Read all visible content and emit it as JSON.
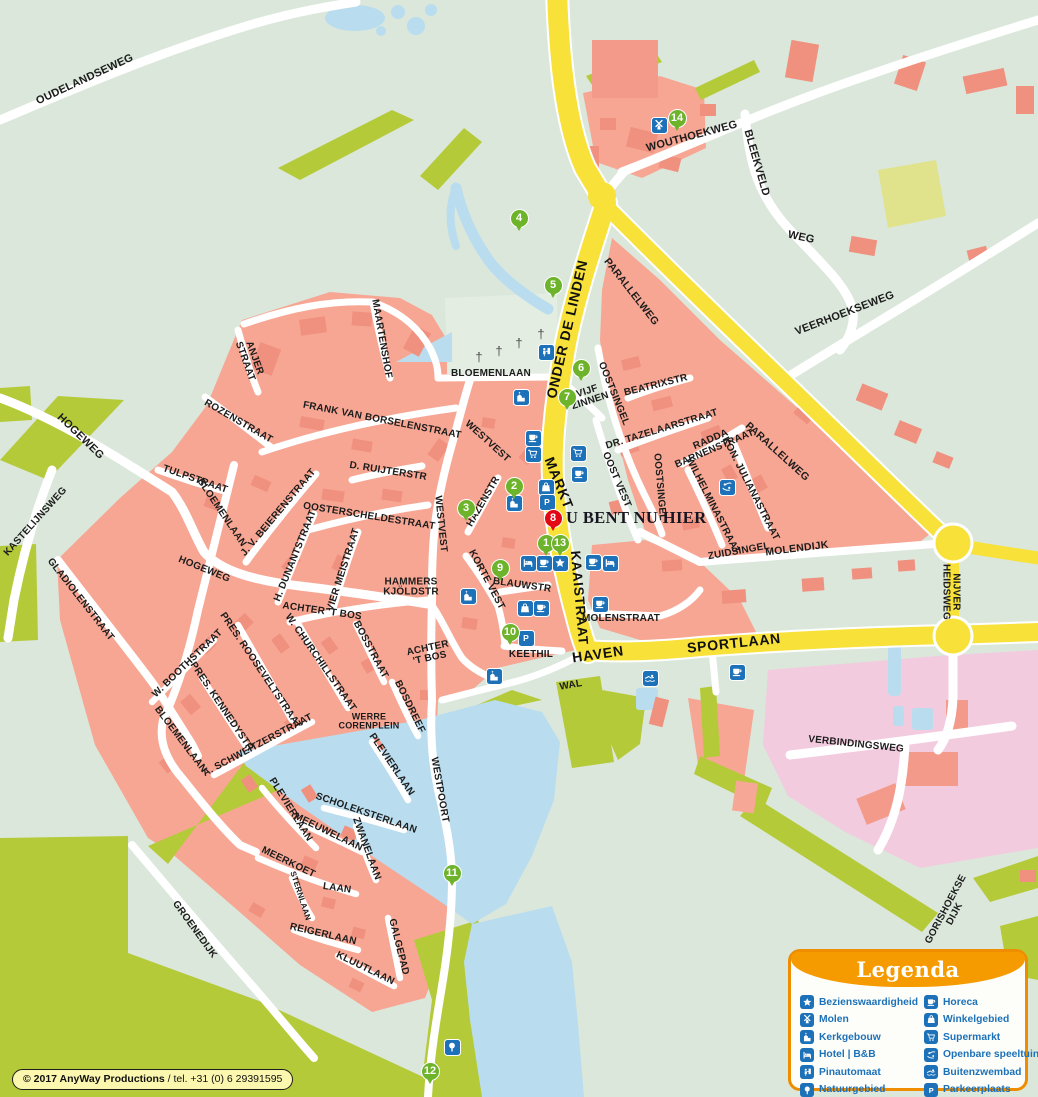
{
  "map": {
    "you_are_here": "U BENT NU HIER",
    "copyright": {
      "owner": "© 2017 AnyWay Productions",
      "phone": " / tel. +31 (0) 6 29391595"
    },
    "colors": {
      "background": "#dbe7db",
      "urban": "#f7a693",
      "buildings": "#f0907f",
      "green_area": "#b5ca38",
      "water": "#b9ddef",
      "industry_pink": "#f3cbdf",
      "main_road_yellow": "#f8e139",
      "icon_blue": "#1d71b8",
      "marker_green": "#6db32b",
      "marker_red": "#e30615",
      "legend_orange": "#f59b00",
      "legend_text_blue": "#1d71b8",
      "copyright_yellow": "#fbf7ae"
    },
    "legend": {
      "title": "Legenda",
      "columns": [
        [
          {
            "icon": "star",
            "label": "Bezienswaardigheid"
          },
          {
            "icon": "windmill",
            "label": "Molen"
          },
          {
            "icon": "church",
            "label": "Kerkgebouw"
          },
          {
            "icon": "bed",
            "label": "Hotel | B&B"
          },
          {
            "icon": "atm",
            "label": "Pinautomaat"
          },
          {
            "icon": "tree",
            "label": "Natuurgebied"
          }
        ],
        [
          {
            "icon": "cup",
            "label": "Horeca"
          },
          {
            "icon": "bag",
            "label": "Winkelgebied"
          },
          {
            "icon": "cart",
            "label": "Supermarkt"
          },
          {
            "icon": "playground",
            "label": "Openbare speeltuin"
          },
          {
            "icon": "swimmer",
            "label": "Buitenzwembad"
          },
          {
            "icon": "parking",
            "label": "Parkeerplaats"
          }
        ]
      ]
    },
    "markers": [
      {
        "n": "1",
        "x": 546,
        "y": 543,
        "color": "green"
      },
      {
        "n": "2",
        "x": 514,
        "y": 486,
        "color": "green"
      },
      {
        "n": "3",
        "x": 466,
        "y": 508,
        "color": "green"
      },
      {
        "n": "4",
        "x": 519,
        "y": 218,
        "color": "green"
      },
      {
        "n": "5",
        "x": 553,
        "y": 285,
        "color": "green"
      },
      {
        "n": "6",
        "x": 581,
        "y": 368,
        "color": "green"
      },
      {
        "n": "7",
        "x": 567,
        "y": 397,
        "color": "green"
      },
      {
        "n": "8",
        "x": 553,
        "y": 518,
        "color": "red"
      },
      {
        "n": "9",
        "x": 500,
        "y": 568,
        "color": "green"
      },
      {
        "n": "10",
        "x": 510,
        "y": 632,
        "color": "green"
      },
      {
        "n": "11",
        "x": 452,
        "y": 873,
        "color": "green"
      },
      {
        "n": "12",
        "x": 430,
        "y": 1071,
        "color": "green"
      },
      {
        "n": "13",
        "x": 560,
        "y": 543,
        "color": "green"
      },
      {
        "n": "14",
        "x": 677,
        "y": 118,
        "color": "green"
      }
    ],
    "pois": [
      {
        "type": "windmill",
        "x": 659,
        "y": 125
      },
      {
        "type": "atm",
        "x": 546,
        "y": 352
      },
      {
        "type": "church",
        "x": 521,
        "y": 397
      },
      {
        "type": "cup",
        "x": 533,
        "y": 438
      },
      {
        "type": "cart",
        "x": 533,
        "y": 454
      },
      {
        "type": "cart",
        "x": 578,
        "y": 453
      },
      {
        "type": "cup",
        "x": 579,
        "y": 474
      },
      {
        "type": "bag",
        "x": 546,
        "y": 487
      },
      {
        "type": "parking",
        "x": 547,
        "y": 502
      },
      {
        "type": "church",
        "x": 514,
        "y": 503
      },
      {
        "type": "bed",
        "x": 528,
        "y": 563
      },
      {
        "type": "cup",
        "x": 544,
        "y": 563
      },
      {
        "type": "star",
        "x": 560,
        "y": 563
      },
      {
        "type": "cup",
        "x": 593,
        "y": 562
      },
      {
        "type": "bed",
        "x": 610,
        "y": 563
      },
      {
        "type": "church",
        "x": 468,
        "y": 596
      },
      {
        "type": "cup",
        "x": 600,
        "y": 604
      },
      {
        "type": "bag",
        "x": 525,
        "y": 608
      },
      {
        "type": "cup",
        "x": 541,
        "y": 608
      },
      {
        "type": "parking",
        "x": 526,
        "y": 638
      },
      {
        "type": "church",
        "x": 494,
        "y": 676
      },
      {
        "type": "swimmer",
        "x": 650,
        "y": 678
      },
      {
        "type": "cup",
        "x": 737,
        "y": 672
      },
      {
        "type": "playground",
        "x": 727,
        "y": 487
      },
      {
        "type": "tree",
        "x": 452,
        "y": 1047
      }
    ],
    "street_labels": [
      {
        "t": "OUDELANDSEWEG",
        "x": 85,
        "y": 80,
        "r": -25,
        "s": 11
      },
      {
        "t": "WOUTHOEKWEG",
        "x": 692,
        "y": 137,
        "r": -15,
        "s": 11
      },
      {
        "t": "BLEEKVELD",
        "x": 756,
        "y": 163,
        "r": 74,
        "s": 11
      },
      {
        "t": "WEG",
        "x": 801,
        "y": 238,
        "r": 12,
        "s": 11
      },
      {
        "t": "VEERHOEKSEWEG",
        "x": 845,
        "y": 314,
        "r": -21,
        "s": 11
      },
      {
        "t": "PARALLELWEG",
        "x": 631,
        "y": 292,
        "r": 52,
        "s": 10.5
      },
      {
        "t": "PARALLELWEG",
        "x": 777,
        "y": 452,
        "r": 42,
        "s": 10.5
      },
      {
        "t": "ONDER DE LINDEN",
        "x": 567,
        "y": 329,
        "r": -77,
        "s": 14,
        "road": true
      },
      {
        "t": "MARKT",
        "x": 559,
        "y": 483,
        "r": 68,
        "s": 14,
        "road": true
      },
      {
        "t": "KAAISTRAAT",
        "x": 579,
        "y": 598,
        "r": 85,
        "s": 13.5,
        "road": true
      },
      {
        "t": "HAVEN",
        "x": 598,
        "y": 654,
        "r": -8,
        "s": 14,
        "road": true
      },
      {
        "t": "SPORTLAAN",
        "x": 734,
        "y": 643,
        "r": -6,
        "s": 14,
        "road": true
      },
      {
        "lines": [
          "NIJVER",
          "HEIDSWEG"
        ],
        "x": 950,
        "y": 592,
        "r": 90,
        "s": 10
      },
      {
        "t": "MOLENDIJK",
        "x": 797,
        "y": 549,
        "r": -7,
        "s": 10.5
      },
      {
        "t": "ZUIDSINGEL",
        "x": 739,
        "y": 552,
        "r": -10,
        "s": 10
      },
      {
        "t": "VERBINDINGSWEG",
        "x": 856,
        "y": 745,
        "r": 6,
        "s": 10
      },
      {
        "t": "GORISHOEKSE DIJK",
        "x": 951,
        "y": 912,
        "r": -62,
        "s": 10
      },
      {
        "t": "BLOEMENLAAN",
        "x": 491,
        "y": 374,
        "r": 0,
        "s": 10
      },
      {
        "t": "MAARTENSHOF",
        "x": 381,
        "y": 339,
        "r": 80,
        "s": 10
      },
      {
        "t": "FRANK VAN BORSELENSTRAAT",
        "x": 382,
        "y": 421,
        "r": 11,
        "s": 10
      },
      {
        "t": "D. RUIJTERSTR",
        "x": 388,
        "y": 472,
        "r": 9,
        "s": 10
      },
      {
        "t": "OOSTERSCHELDESTRAAT",
        "x": 369,
        "y": 517,
        "r": 9,
        "s": 10
      },
      {
        "t": "WESTVEST",
        "x": 487,
        "y": 442,
        "r": 42,
        "s": 10
      },
      {
        "t": "WESTVEST",
        "x": 440,
        "y": 524,
        "r": 84,
        "s": 10
      },
      {
        "t": "HAZENSTR",
        "x": 484,
        "y": 502,
        "r": -60,
        "s": 10
      },
      {
        "t": "KORTE VEST",
        "x": 486,
        "y": 580,
        "r": 62,
        "s": 10
      },
      {
        "t": "BLAUWSTR",
        "x": 522,
        "y": 586,
        "r": 8,
        "s": 10
      },
      {
        "lines": [
          "HAMMERS",
          "KJÖLDSTR"
        ],
        "x": 411,
        "y": 588,
        "r": 0,
        "s": 10
      },
      {
        "t": "ACHTER 'T BOS",
        "x": 322,
        "y": 612,
        "r": 8,
        "s": 10
      },
      {
        "lines": [
          "ACHTER",
          "'T BOS"
        ],
        "x": 429,
        "y": 654,
        "r": -12,
        "s": 10
      },
      {
        "t": "KEETHIL",
        "x": 531,
        "y": 655,
        "r": 0,
        "s": 10
      },
      {
        "t": "WAL",
        "x": 571,
        "y": 686,
        "r": -10,
        "s": 10
      },
      {
        "t": "MOLENSTRAAT",
        "x": 621,
        "y": 619,
        "r": 0,
        "s": 10
      },
      {
        "t": "OOST VEST",
        "x": 616,
        "y": 480,
        "r": 67,
        "s": 10
      },
      {
        "t": "OOSTSINGEL",
        "x": 613,
        "y": 394,
        "r": 68,
        "s": 10
      },
      {
        "t": "OOSTSINGEL",
        "x": 659,
        "y": 487,
        "r": 85,
        "s": 10
      },
      {
        "lines": [
          "VIJF",
          "ZINNEN"
        ],
        "x": 589,
        "y": 397,
        "r": -18,
        "s": 10
      },
      {
        "t": "BEATRIXSTR",
        "x": 656,
        "y": 386,
        "r": -14,
        "s": 10
      },
      {
        "t": "DR. TAZELAARSTRAAT",
        "x": 662,
        "y": 430,
        "r": -17,
        "s": 10
      },
      {
        "lines": [
          "RADDA",
          "BARNENSTRAAT"
        ],
        "x": 713,
        "y": 445,
        "r": -23,
        "s": 10
      },
      {
        "t": "KON. JULIANASTRAAT",
        "x": 750,
        "y": 489,
        "r": 63,
        "s": 10
      },
      {
        "t": "WILHELMINASTRAAT",
        "x": 712,
        "y": 506,
        "r": 63,
        "s": 10
      },
      {
        "t": "ROZENSTRAAT",
        "x": 238,
        "y": 422,
        "r": 30,
        "s": 10
      },
      {
        "t": "TULPSTRAAT",
        "x": 195,
        "y": 480,
        "r": 19,
        "s": 10
      },
      {
        "t": "BLOEMENLAAN",
        "x": 221,
        "y": 513,
        "r": 56,
        "s": 10
      },
      {
        "lines": [
          "ANJER",
          "STRAAT"
        ],
        "x": 249,
        "y": 360,
        "r": 70,
        "s": 10
      },
      {
        "t": "HOGEWEG",
        "x": 80,
        "y": 437,
        "r": 44,
        "s": 11
      },
      {
        "t": "KASTELIJNSWEG",
        "x": 36,
        "y": 522,
        "r": -48,
        "s": 10
      },
      {
        "t": "HOGEWEG",
        "x": 204,
        "y": 570,
        "r": 22,
        "s": 10
      },
      {
        "t": "GLADIOLENSTRAAT",
        "x": 80,
        "y": 600,
        "r": 52,
        "s": 10
      },
      {
        "t": "J. V. BEIERENSTRAAT",
        "x": 279,
        "y": 513,
        "r": -50,
        "s": 10
      },
      {
        "t": "H. DUNANTSTRAAT",
        "x": 296,
        "y": 556,
        "r": -68,
        "s": 10
      },
      {
        "t": "VIER MEISTRAAT",
        "x": 344,
        "y": 570,
        "r": -72,
        "s": 10
      },
      {
        "t": "PRES. ROOSEVELTSTRAAT",
        "x": 260,
        "y": 671,
        "r": 56,
        "s": 10
      },
      {
        "t": "PRES. KENNEDYSTR",
        "x": 221,
        "y": 707,
        "r": 56,
        "s": 10
      },
      {
        "t": "W. BOOTHSTRAAT",
        "x": 188,
        "y": 664,
        "r": -44,
        "s": 10
      },
      {
        "t": "W. CHURCHILLSTRAAT",
        "x": 320,
        "y": 663,
        "r": 55,
        "s": 10
      },
      {
        "t": "BOSSTRAAT",
        "x": 370,
        "y": 650,
        "r": 62,
        "s": 10
      },
      {
        "t": "BOSDREEF",
        "x": 409,
        "y": 707,
        "r": 64,
        "s": 10
      },
      {
        "lines": [
          "WERRE",
          "CORENPLEIN"
        ],
        "x": 369,
        "y": 722,
        "r": 0,
        "s": 9
      },
      {
        "t": "A. SCHWEITZERSTRAAT",
        "x": 258,
        "y": 746,
        "r": -28,
        "s": 10
      },
      {
        "t": "BLOEMENLAAN",
        "x": 180,
        "y": 740,
        "r": 53,
        "s": 10
      },
      {
        "t": "PLEVIERLAAN",
        "x": 290,
        "y": 810,
        "r": 58,
        "s": 10
      },
      {
        "t": "PLEVIERLAAN",
        "x": 391,
        "y": 765,
        "r": 56,
        "s": 10
      },
      {
        "t": "WESTPOORT",
        "x": 439,
        "y": 790,
        "r": 80,
        "s": 10
      },
      {
        "t": "SCHOLEKSTERLAAN",
        "x": 366,
        "y": 814,
        "r": 19,
        "s": 10
      },
      {
        "t": "MEEUWELAAN",
        "x": 328,
        "y": 833,
        "r": 26,
        "s": 10
      },
      {
        "t": "ZWANELAAN",
        "x": 366,
        "y": 849,
        "r": 70,
        "s": 10
      },
      {
        "t": "MEERKOET",
        "x": 288,
        "y": 863,
        "r": 26,
        "s": 10
      },
      {
        "t": "LAAN",
        "x": 337,
        "y": 889,
        "r": 8,
        "s": 10
      },
      {
        "t": "STERNLAAN",
        "x": 300,
        "y": 896,
        "r": 72,
        "s": 8
      },
      {
        "t": "REIGERLAAN",
        "x": 323,
        "y": 935,
        "r": 13,
        "s": 10
      },
      {
        "t": "KLUUTLAAN",
        "x": 365,
        "y": 969,
        "r": 26,
        "s": 10
      },
      {
        "t": "GALGEPAD",
        "x": 398,
        "y": 947,
        "r": 76,
        "s": 10
      },
      {
        "t": "GROENEDIJK",
        "x": 194,
        "y": 930,
        "r": 54,
        "s": 10
      },
      {
        "t": "†",
        "x": 479,
        "y": 357,
        "r": 0,
        "s": 13,
        "cross": true
      },
      {
        "t": "†",
        "x": 499,
        "y": 351,
        "r": 0,
        "s": 13,
        "cross": true
      },
      {
        "t": "†",
        "x": 519,
        "y": 343,
        "r": 0,
        "s": 13,
        "cross": true
      },
      {
        "t": "†",
        "x": 541,
        "y": 334,
        "r": 0,
        "s": 13,
        "cross": true
      }
    ]
  }
}
